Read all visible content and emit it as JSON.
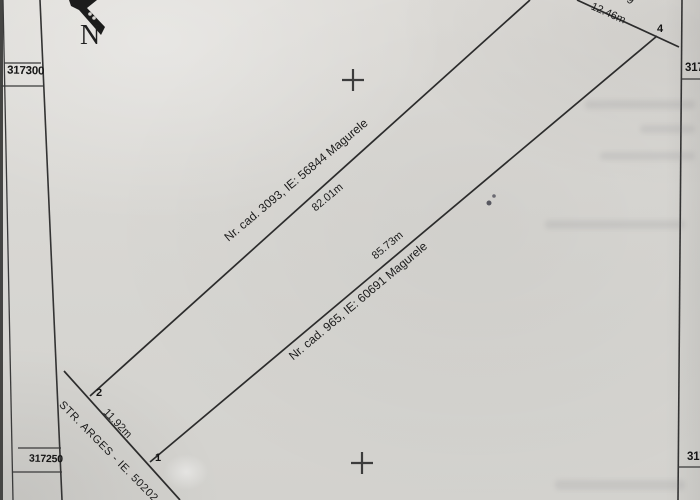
{
  "plan": {
    "compass_label": "N",
    "grid_labels": {
      "left_top": "317300",
      "left_bottom": "317250",
      "right_top": "317",
      "right_bottom": "317"
    },
    "boundaries": {
      "upper_neighbor": "Nr. cad. 3093, IE: 56844 Magurele",
      "upper_side_length": "82.01m",
      "lower_neighbor": "Nr. cad. 965, IE: 60691 Magurele",
      "lower_side_length": "85.73m",
      "street": "STR. ARGES - IE. 50202",
      "street_frontage_length": "11.92m",
      "rear_side_length": "12.46m",
      "clipped_top_text": "9"
    },
    "corner_points": {
      "p1": "1",
      "p2": "2",
      "p4": "4"
    }
  },
  "colors": {
    "paper": "#d8d6d2",
    "ink": "#1c1c1c",
    "boundary_line": "#2c2c2c"
  }
}
